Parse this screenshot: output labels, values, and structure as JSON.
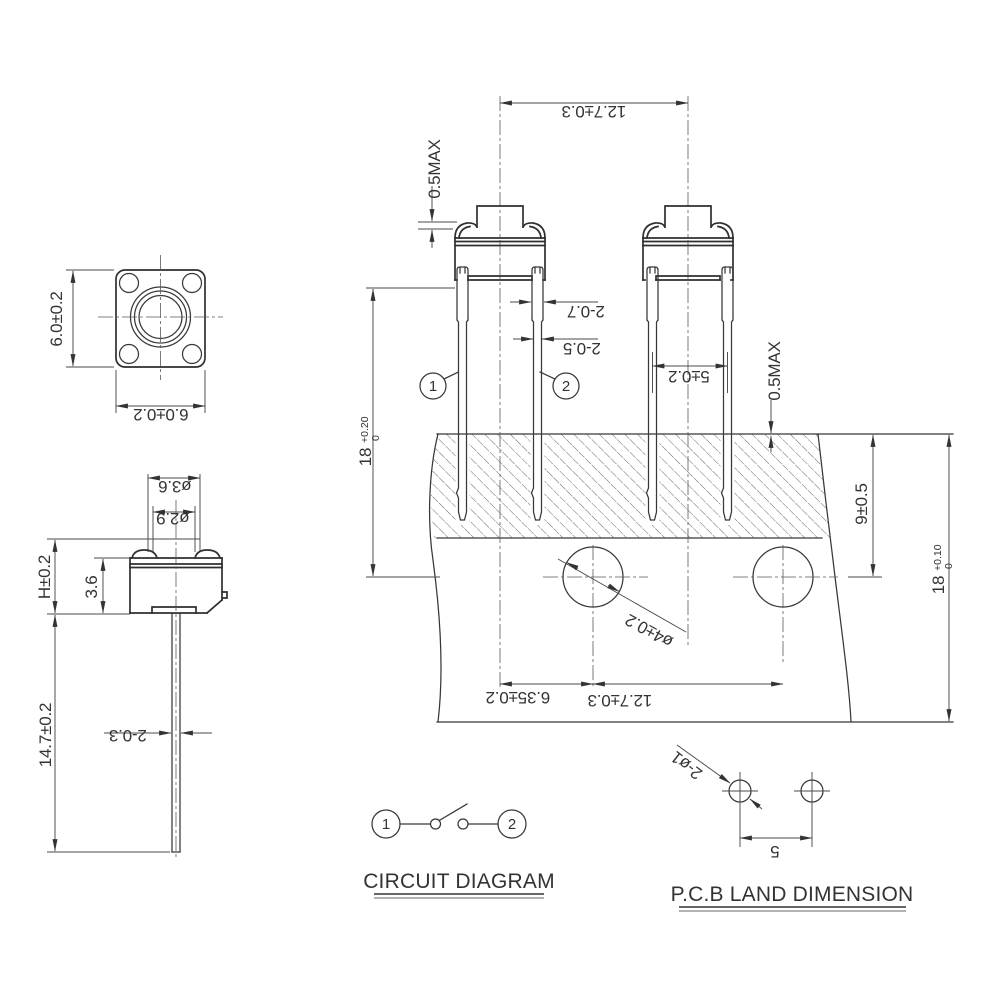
{
  "colors": {
    "line": "#2f2f2f",
    "dim_line": "#4a4a4a",
    "text": "#333333",
    "background": "#ffffff"
  },
  "top_view": {
    "dim_width": "6.0±0.2",
    "dim_height": "6.0±0.2"
  },
  "side_view": {
    "dim_stem_outer": "ø3.6",
    "dim_stem_inner": "ø2.9",
    "dim_height": "H±0.2",
    "dim_body_height": "3.6",
    "dim_lead_length": "14.7±0.2",
    "dim_lead_width": "2-0.3"
  },
  "front_view": {
    "dim_pitch_top": "12.7±0.3",
    "dim_button_protrusion": "0.5MAX",
    "dim_lead_wide": "2-0.7",
    "dim_lead_narrow": "2-0.5",
    "dim_leg_span": "5±0.2",
    "pin1": "1",
    "pin2": "2",
    "dim_depth_base": "18",
    "dim_depth_tol_upper": "+0.20",
    "dim_depth_tol_lower": "0",
    "dim_standoff": "0.5MAX",
    "dim_hole_center": "9±0.5",
    "dim_panel_base": "18",
    "dim_panel_tol_upper": "+0.10",
    "dim_panel_tol_lower": "0",
    "dim_hole_dia": "ø4±0.2",
    "dim_offset": "6.35±0.2",
    "dim_pitch_bottom": "12.7±0.3"
  },
  "circuit": {
    "title": "CIRCUIT DIAGRAM",
    "pin1": "1",
    "pin2": "2"
  },
  "pcb_land": {
    "title": "P.C.B LAND DIMENSION",
    "dim_hole_dia": "2-ø1",
    "dim_pitch": "5"
  }
}
